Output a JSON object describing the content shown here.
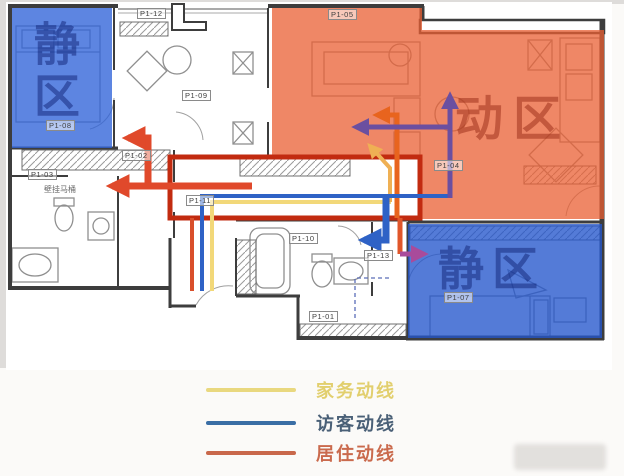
{
  "figure": {
    "type": "apartment-floor-plan-circulation-diagram",
    "zones": {
      "quiet_top_left": {
        "label": "静区",
        "fill": "#2f63d8"
      },
      "active": {
        "label": "动区",
        "fill": "#e95f33"
      },
      "quiet_bottom_right": {
        "label": "静区",
        "fill": "#2456cc"
      }
    },
    "room_tags": [
      {
        "label": "P1-12"
      },
      {
        "label": "P1-09"
      },
      {
        "label": "P1-08"
      },
      {
        "label": "P1-03"
      },
      {
        "label": "P1-02"
      },
      {
        "label": "P1-11"
      },
      {
        "label": "P1-10"
      },
      {
        "label": "P1-13"
      },
      {
        "label": "P1-01"
      },
      {
        "label": "P1-05"
      },
      {
        "label": "P1-04"
      },
      {
        "label": "P1-07"
      }
    ],
    "annotations": [
      {
        "label": "壁挂马桶"
      }
    ],
    "legend": {
      "items": [
        {
          "label": "家务动线",
          "line_color": "#e9d87f",
          "text_color": "#e2cf6e"
        },
        {
          "label": "访客动线",
          "line_color": "#3a6ea5",
          "text_color": "#4a6077"
        },
        {
          "label": "居住动线",
          "line_color": "#c9684b",
          "text_color": "#ca6a4d"
        }
      ]
    },
    "flow_colors": {
      "resident_loop": "#c22b10",
      "resident_arrows": "#e0492b",
      "bedroom_arrow": "#a94b9b",
      "visitor_line": "#2e62c6",
      "visitor_over_zone": "#6b4fa0",
      "housework_line": "#f2d879",
      "housework_arrow": "#efb054",
      "kitchen_arrow": "#e8641e"
    }
  }
}
